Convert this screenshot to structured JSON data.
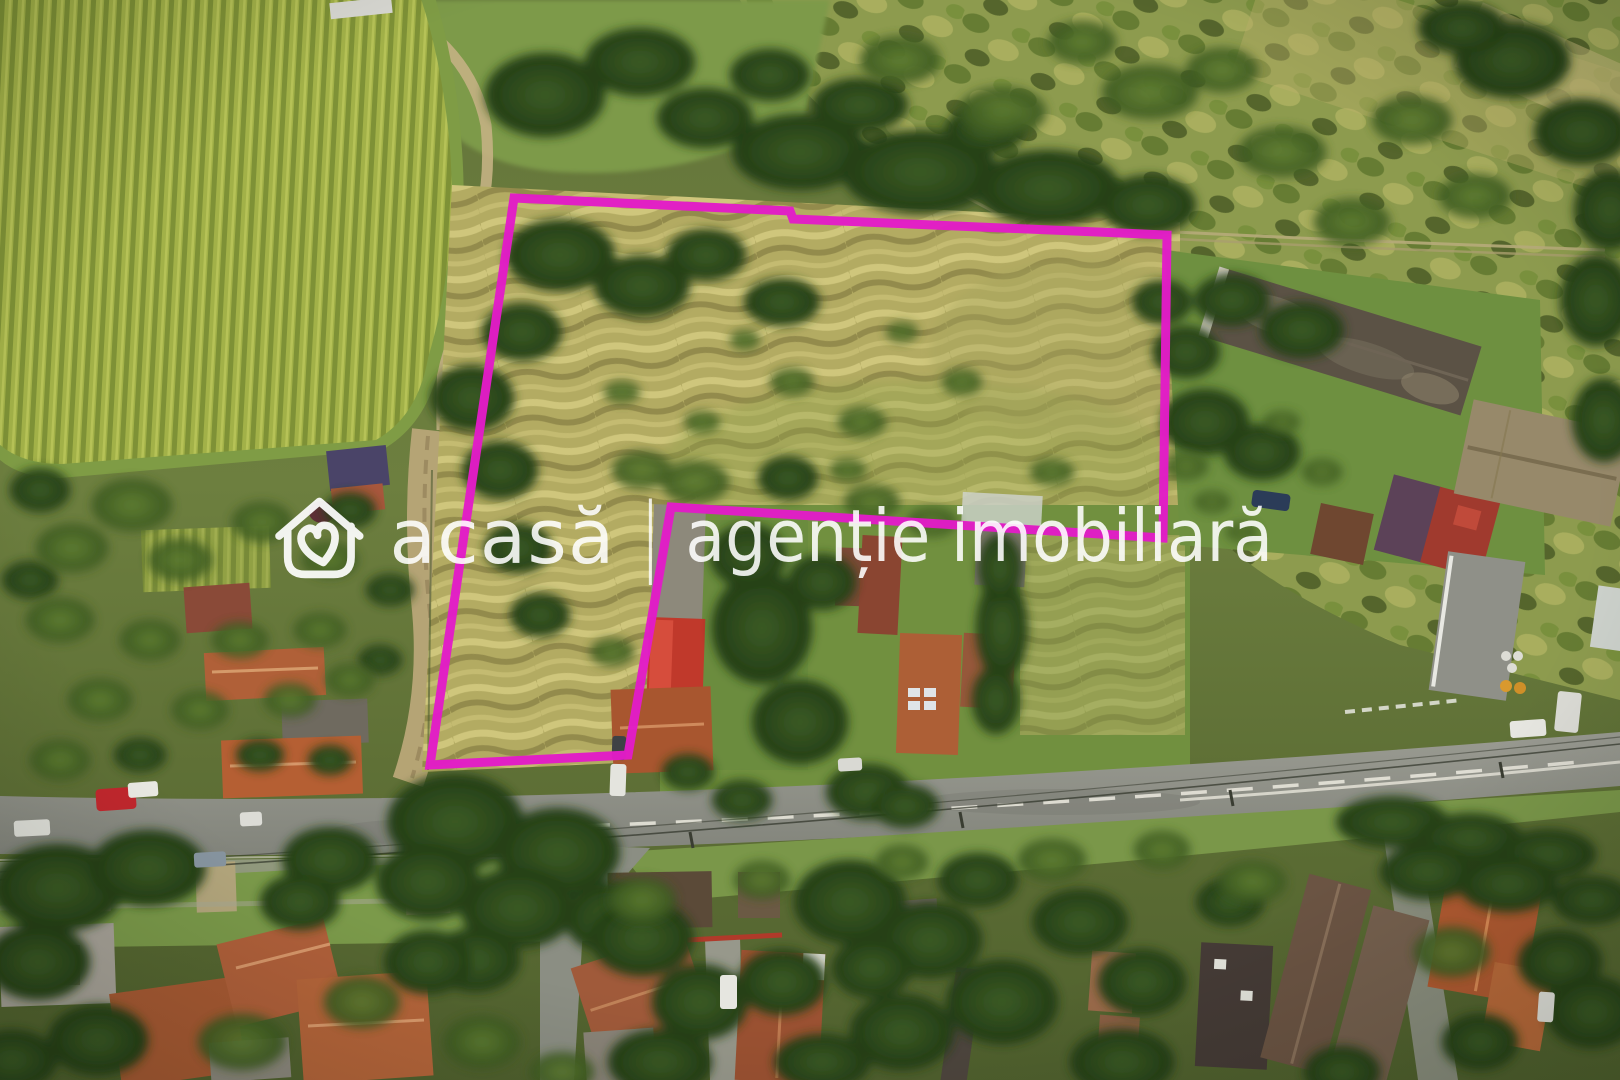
{
  "watermark": {
    "logo": "house-heart-logo",
    "brand": "acasă",
    "separator": "|",
    "tagline": "agenție imobiliară",
    "text_color": "#ffffff"
  },
  "boundary": {
    "color": "#e21cc7",
    "stroke_width": "9",
    "points_str": "514,198 790,211 793,219 1167,235 1163,538 671,507 628,755 430,765"
  }
}
